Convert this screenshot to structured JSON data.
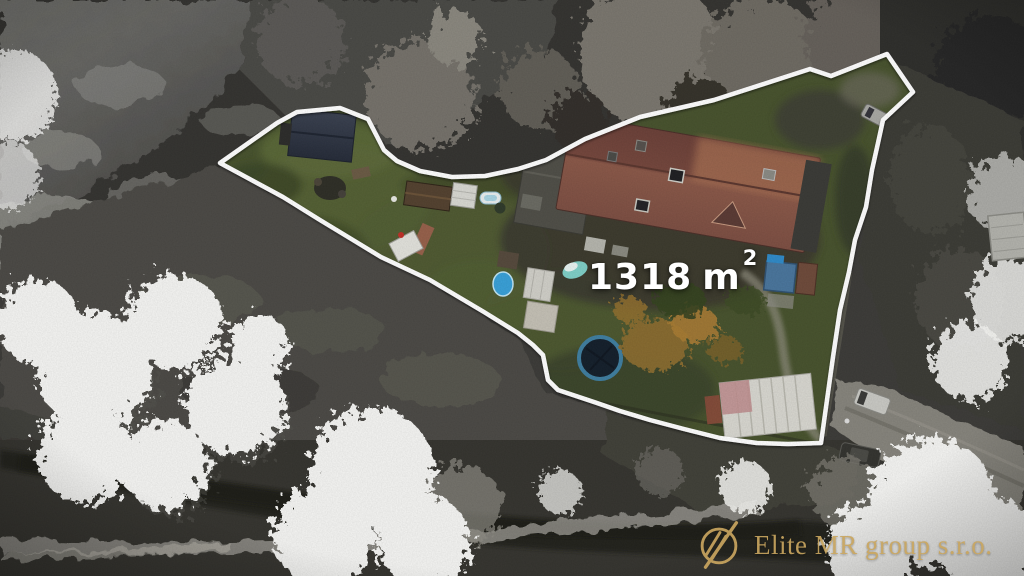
{
  "photo": {
    "area_overlay": {
      "value": "1318",
      "unit": "m",
      "superscript": "2",
      "text_color": "#ffffff"
    },
    "boundary": {
      "color": "#ffffff"
    }
  },
  "watermark": {
    "text": "Elite MR group s.r.o.",
    "color": "#c8a55f",
    "icon": "elite-mr-circle-slashes-logo"
  },
  "palette": {
    "lawn_green": "#47522d",
    "house_roof_red": "#8a5848",
    "cabin_roof_slate": "#333a48",
    "outside_grayscale_base": "#3c3b38",
    "stream_dark": "#22221d",
    "frosty_tree_white": "#f5f5f3",
    "trampoline_ring_blue": "#3f7ea0"
  }
}
